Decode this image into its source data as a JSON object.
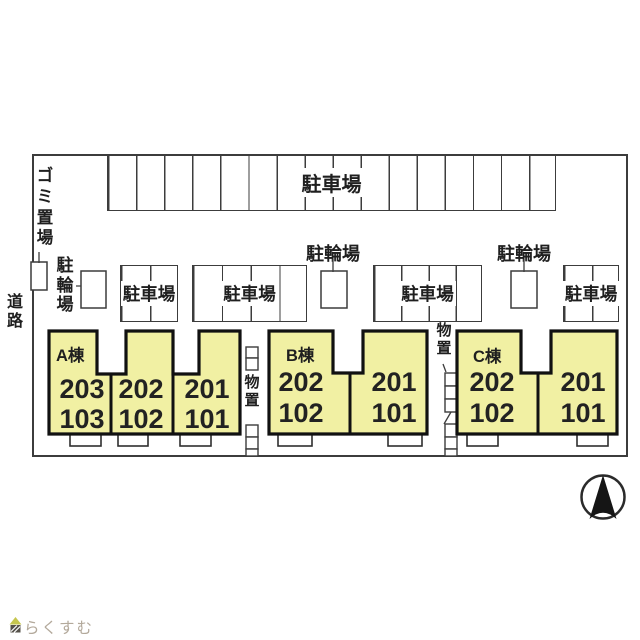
{
  "plan": {
    "road_label": "道路",
    "garbage_label": "ゴミ置場",
    "parking_top_label": "駐車場",
    "parking_mid1_label": "駐車場",
    "parking_mid2_label": "駐車場",
    "parking_mid3_label": "駐車場",
    "parking_mid4_label": "駐車場",
    "bicycle1_label": "駐輪場",
    "bicycle2_label": "駐輪場",
    "bicycle3_label": "駐輪場",
    "storage1_label": "物置",
    "storage2_label": "物置"
  },
  "buildings": [
    {
      "name": "A棟",
      "units": [
        {
          "upper": "203",
          "lower": "103"
        },
        {
          "upper": "202",
          "lower": "102"
        },
        {
          "upper": "201",
          "lower": "101"
        }
      ]
    },
    {
      "name": "B棟",
      "units": [
        {
          "upper": "202",
          "lower": "102"
        },
        {
          "upper": "201",
          "lower": "101"
        }
      ]
    },
    {
      "name": "C棟",
      "units": [
        {
          "upper": "202",
          "lower": "102"
        },
        {
          "upper": "201",
          "lower": "101"
        }
      ]
    }
  ],
  "branding": {
    "logo_text": "らくすむ"
  },
  "colors": {
    "building_fill": "#f1f0a3",
    "line": "#3c3c3c",
    "logo_text": "#b3a99b",
    "logo_roof": "#c6c64f",
    "logo_body": "#55514a"
  }
}
